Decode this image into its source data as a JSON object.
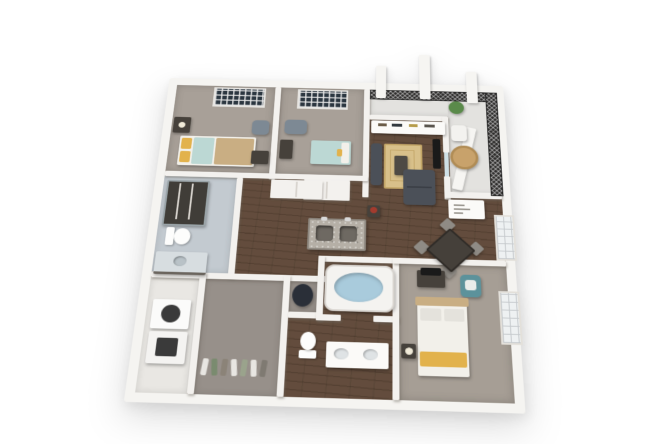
{
  "scene": {
    "kind": "3d-floorplan-render",
    "background": "#ffffff",
    "view": "isometric bird's-eye, two-bedroom apartment with den, white walls, dark hardwood living areas"
  },
  "palette": {
    "wall": "#f3f1ee",
    "wall_outer": "#f5f4f1",
    "hardwood": "#5e4737",
    "carpet": "#a8a098",
    "carpet_master": "#a69e95",
    "closet_floor": "#97908a",
    "laundry_floor": "#e9e7e3",
    "bath_tile": "#c3cad0",
    "balcony_floor": "#e3e2df",
    "railing": "#2e2d2c",
    "granite": "#b5afa6",
    "sink_dark": "#6e6962",
    "water": "#a9cbdc",
    "tub_white": "#f4f3f0",
    "sofa": "#4b5058",
    "rug": "#d8c08a",
    "coffee_table": "#4e4a44",
    "wood_light": "#c9ae83",
    "yellow": "#e2b24c",
    "blue_bed": "#bcd8d4",
    "white_linen": "#f2f0ea",
    "pillow_gray": "#e4e2dc",
    "dark_furniture": "#46413b",
    "tv": "#1a1a1a",
    "teal_chair": "#5c929b",
    "chair_gray": "#7d8994",
    "plant": "#5a8a4a",
    "red_flower": "#a33b2e",
    "window_dark": "#2b3640",
    "dining_table": "#45403a",
    "dining_chair": "#8f8b85",
    "bistro": "#c8a26b",
    "vanity_top": "#d7dde0",
    "shower_dark": "#403d38",
    "glass": "#cfe0e6",
    "closet_item": "#2a2f38",
    "appliance_front": "#3a3a3a"
  },
  "rooms": [
    {
      "id": "bedroom-a",
      "name": "Bedroom A",
      "floor": "carpet"
    },
    {
      "id": "bedroom-b",
      "name": "Bedroom B",
      "floor": "carpet"
    },
    {
      "id": "living-room",
      "name": "Living Room",
      "floor": "hardwood"
    },
    {
      "id": "balcony",
      "name": "Balcony",
      "floor": "balcony_floor"
    },
    {
      "id": "kitchen-dining",
      "name": "Kitchen / Dining",
      "floor": "hardwood"
    },
    {
      "id": "bathroom-2",
      "name": "Bathroom",
      "floor": "bath_tile"
    },
    {
      "id": "laundry",
      "name": "Laundry Closet",
      "floor": "laundry_floor"
    },
    {
      "id": "walk-in-closet",
      "name": "Walk-in Closet",
      "floor": "closet_floor"
    },
    {
      "id": "master-bathroom",
      "name": "Master Bathroom",
      "floor": "hardwood"
    },
    {
      "id": "master-bedroom",
      "name": "Master Bedroom",
      "floor": "carpet_master"
    }
  ],
  "furniture": {
    "bedroom_a": [
      "bed with yellow pillows and wood foot",
      "dresser with lamp",
      "armchair",
      "desk",
      "paned window"
    ],
    "bedroom_b": [
      "light blue bed",
      "dark nightstand",
      "armchair",
      "closet",
      "paned window"
    ],
    "living_room": [
      "white media console",
      "wall tv",
      "chaise",
      "gray sofa",
      "tan area rug",
      "coffee table",
      "plant stand with red flowers"
    ],
    "balcony": [
      "black mesh railing",
      "white pillars",
      "potted plant",
      "wicker bistro table",
      "white chair"
    ],
    "kitchen_dining": [
      "granite island with two sinks and faucets",
      "square dining table with four chairs",
      "white buffet cabinet"
    ],
    "bathroom_2": [
      "dark tiled shower",
      "toilet",
      "glass-top vanity"
    ],
    "laundry": [
      "stacked washer and dryer"
    ],
    "walk_in_closet": [
      "hanging clothes",
      "dark hamper"
    ],
    "master_bathroom": [
      "soaking tub with water",
      "toilet",
      "double vanity"
    ],
    "master_bedroom": [
      "bed with yellow throw",
      "dresser with tv",
      "teal armchair",
      "nightstand with lamp",
      "paned window"
    ]
  }
}
